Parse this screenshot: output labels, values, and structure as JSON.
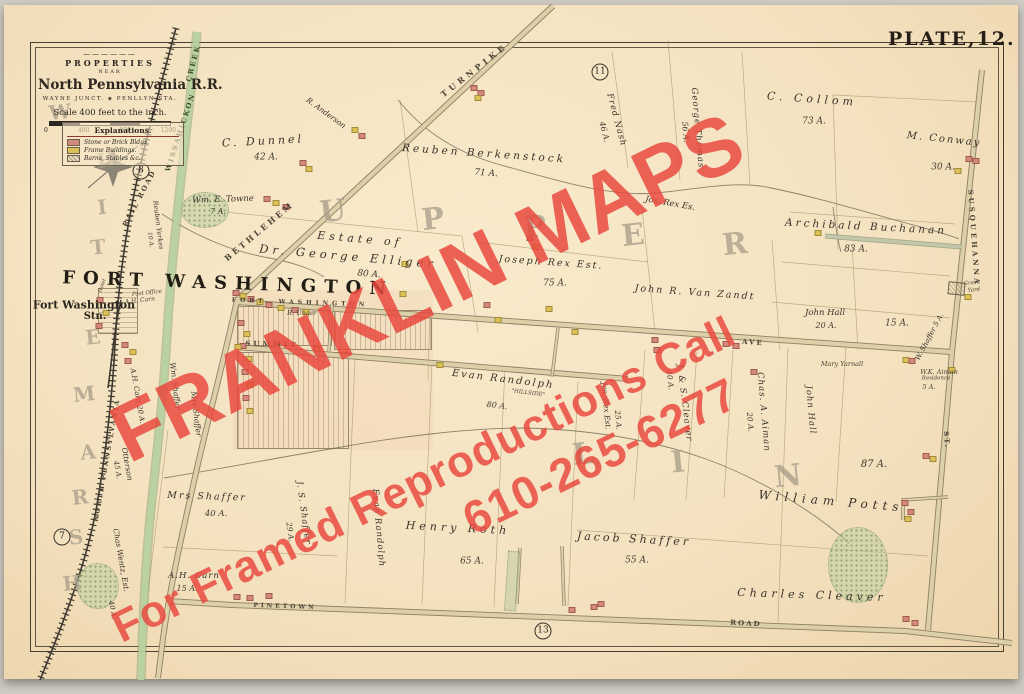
{
  "plate_label": "PLATE,12.",
  "title_block": {
    "ornament": "——————",
    "properties": "PROPERTIES",
    "near": "NEAR",
    "railroad": "North Pennsylvania R.R.",
    "stations": "WAYNE JUNCT. ◈ PENLLYN STA.",
    "scale_caption": "Scale 400 feet to the inch.",
    "scale_ticks": [
      "0",
      "400",
      "800",
      "1200"
    ]
  },
  "legend": {
    "title": "Explanations.",
    "items": [
      {
        "label": "Stone or Brick Bldgs.",
        "swatch": "stone",
        "color": "#d4897e"
      },
      {
        "label": "Frame Buildings.",
        "swatch": "frame",
        "color": "#dcc156"
      },
      {
        "label": "Barns, Stables &c.",
        "swatch": "barn",
        "color": "#e8dcbe"
      }
    ]
  },
  "watermark": {
    "line1": "FRANKLIN MAPS",
    "line2": "For Framed Reproductions Call",
    "line3": "610-265-6277",
    "color": "#e9483e"
  },
  "map_labels": [
    {
      "t": "TURNPIKE",
      "x": 474,
      "y": 70,
      "rot": -38,
      "fs": 8,
      "ls": 4,
      "cls": "road"
    },
    {
      "t": "BETHLEHEM",
      "x": 259,
      "y": 231,
      "rot": -40,
      "fs": 8,
      "ls": 3,
      "cls": "road"
    },
    {
      "t": "FORT  WASHINGTON",
      "x": 300,
      "y": 303,
      "rot": 2,
      "fs": 6,
      "ls": 4,
      "cls": "road"
    },
    {
      "t": "AVE",
      "x": 753,
      "y": 342,
      "rot": 4,
      "fs": 7,
      "ls": 2,
      "cls": "road"
    },
    {
      "t": "SUMMIT",
      "x": 272,
      "y": 344,
      "rot": 2,
      "fs": 7,
      "ls": 3,
      "cls": "road"
    },
    {
      "t": "PINETOWN",
      "x": 285,
      "y": 607,
      "rot": 2,
      "fs": 6,
      "ls": 3,
      "cls": "road"
    },
    {
      "t": "ROAD",
      "x": 746,
      "y": 623,
      "rot": 3,
      "fs": 7,
      "ls": 2,
      "cls": "road"
    },
    {
      "t": "SUSQUEHANNA",
      "x": 974,
      "y": 238,
      "rot": 86,
      "fs": 7,
      "ls": 3,
      "cls": "road"
    },
    {
      "t": "ST.",
      "x": 947,
      "y": 440,
      "rot": 86,
      "fs": 7,
      "ls": 2,
      "cls": "road"
    },
    {
      "t": "NORTH PENNSYLVANIA",
      "x": 107,
      "y": 460,
      "rot": -80,
      "fs": 6.5,
      "ls": 2,
      "cls": "road"
    },
    {
      "t": "RAIL ROAD",
      "x": 139,
      "y": 198,
      "rot": -62,
      "fs": 7,
      "ls": 2,
      "cls": "road"
    },
    {
      "t": "WISSAHICKON",
      "x": 180,
      "y": 132,
      "rot": -72,
      "fs": 7,
      "ls": 2,
      "cls": "creek"
    },
    {
      "t": "CREEK",
      "x": 193,
      "y": 63,
      "rot": -75,
      "fs": 7,
      "ls": 2,
      "cls": "creek"
    },
    {
      "t": "FORT WASHINGTON",
      "x": 228,
      "y": 284,
      "rot": 2,
      "fs": 18,
      "ls": 8,
      "cls": "village"
    },
    {
      "t": "Fort Washington",
      "x": 84,
      "y": 305,
      "fs": 11,
      "cls": "station"
    },
    {
      "t": "Stn.",
      "x": 95,
      "y": 317,
      "fs": 10,
      "cls": "station"
    },
    {
      "t": "Post Office",
      "x": 147,
      "y": 294,
      "rot": -6,
      "fs": 5.5,
      "cls": "tiny"
    },
    {
      "t": "A.H. Carn",
      "x": 140,
      "y": 301,
      "rot": -6,
      "fs": 6,
      "cls": "tiny"
    },
    {
      "t": "Hotel",
      "x": 103,
      "y": 286,
      "rot": -70,
      "fs": 5,
      "cls": "tiny"
    },
    {
      "t": "R. Unger",
      "x": 302,
      "y": 313,
      "fs": 6.5,
      "cls": "tiny"
    },
    {
      "t": "Mary Yarnall",
      "x": 842,
      "y": 364,
      "fs": 6.5,
      "cls": "tiny"
    },
    {
      "t": "W.K. Aiman",
      "x": 939,
      "y": 372,
      "fs": 6.5,
      "cls": "tiny"
    },
    {
      "t": "Residence",
      "x": 936,
      "y": 379,
      "fs": 5.5,
      "cls": "tiny"
    },
    {
      "t": "5 A.",
      "x": 929,
      "y": 387,
      "fs": 6.5,
      "cls": "tiny"
    },
    {
      "t": "Grave",
      "x": 972,
      "y": 284,
      "rot": -6,
      "fs": 5.5,
      "cls": "tiny"
    },
    {
      "t": "Yard",
      "x": 974,
      "y": 291,
      "rot": -6,
      "fs": 5.5,
      "cls": "tiny"
    },
    {
      "t": "C. Dunnel",
      "x": 263,
      "y": 141,
      "rot": -3,
      "fs": 11,
      "ls": 3,
      "cls": "prop"
    },
    {
      "t": "42 A.",
      "x": 266,
      "y": 158,
      "fs": 9,
      "cls": "acre"
    },
    {
      "t": "R. Anderson",
      "x": 326,
      "y": 113,
      "rot": 36,
      "fs": 7.5,
      "cls": "prop"
    },
    {
      "t": "Reuben Berkenstock",
      "x": 484,
      "y": 154,
      "rot": 4,
      "fs": 10.5,
      "ls": 3,
      "cls": "prop"
    },
    {
      "t": "71 A.",
      "x": 486,
      "y": 174,
      "rot": 4,
      "fs": 9,
      "cls": "acre"
    },
    {
      "t": "Fred Nash",
      "x": 616,
      "y": 120,
      "rot": 75,
      "fs": 8.5,
      "ls": 1,
      "cls": "prop"
    },
    {
      "t": "46 A.",
      "x": 604,
      "y": 132,
      "rot": 75,
      "fs": 8,
      "cls": "acre"
    },
    {
      "t": "George Thomas",
      "x": 697,
      "y": 128,
      "rot": 85,
      "fs": 8.5,
      "ls": 1,
      "cls": "prop"
    },
    {
      "t": "56 A.",
      "x": 685,
      "y": 132,
      "rot": 85,
      "fs": 8,
      "cls": "acre"
    },
    {
      "t": "C. Collom",
      "x": 812,
      "y": 99,
      "rot": 4,
      "fs": 11,
      "ls": 4,
      "cls": "prop"
    },
    {
      "t": "73 A.",
      "x": 814,
      "y": 122,
      "fs": 9,
      "cls": "acre"
    },
    {
      "t": "M. Conway",
      "x": 944,
      "y": 140,
      "rot": 6,
      "fs": 10,
      "ls": 2,
      "cls": "prop"
    },
    {
      "t": "30 A.",
      "x": 943,
      "y": 168,
      "fs": 9,
      "cls": "acre"
    },
    {
      "t": "Jos. Rex Es.",
      "x": 670,
      "y": 204,
      "rot": 10,
      "fs": 8.5,
      "cls": "prop"
    },
    {
      "t": "Archibald Buchanan",
      "x": 866,
      "y": 227,
      "rot": 3,
      "fs": 10.5,
      "ls": 3,
      "cls": "prop"
    },
    {
      "t": "83 A.",
      "x": 856,
      "y": 250,
      "fs": 9,
      "cls": "acre"
    },
    {
      "t": "Wm. E. Towne",
      "x": 223,
      "y": 200,
      "rot": -2,
      "fs": 8.5,
      "cls": "prop"
    },
    {
      "t": "7 A.",
      "x": 218,
      "y": 212,
      "fs": 8,
      "cls": "acre"
    },
    {
      "t": "Reuben Yerkes",
      "x": 158,
      "y": 225,
      "rot": 83,
      "fs": 6.5,
      "cls": "prop"
    },
    {
      "t": "10 A.",
      "x": 150,
      "y": 240,
      "rot": 83,
      "fs": 6,
      "cls": "acre"
    },
    {
      "t": "Estate of",
      "x": 360,
      "y": 239,
      "rot": 5,
      "fs": 11,
      "ls": 4,
      "cls": "prop"
    },
    {
      "t": "Dr. George Elliger",
      "x": 348,
      "y": 257,
      "rot": 5,
      "fs": 11.5,
      "ls": 4,
      "cls": "prop"
    },
    {
      "t": "80 A.",
      "x": 369,
      "y": 275,
      "rot": 5,
      "fs": 9,
      "cls": "acre"
    },
    {
      "t": "Joseph Rex Est.",
      "x": 551,
      "y": 263,
      "rot": 4,
      "fs": 9.5,
      "ls": 2,
      "cls": "prop"
    },
    {
      "t": "75 A.",
      "x": 555,
      "y": 284,
      "fs": 9,
      "cls": "acre"
    },
    {
      "t": "John R. Van Zandt",
      "x": 695,
      "y": 293,
      "rot": 4,
      "fs": 9.5,
      "ls": 2,
      "cls": "prop"
    },
    {
      "t": "John Hall",
      "x": 825,
      "y": 313,
      "fs": 8.5,
      "cls": "prop"
    },
    {
      "t": "20 A.",
      "x": 826,
      "y": 326,
      "fs": 8,
      "cls": "acre"
    },
    {
      "t": "15 A.",
      "x": 897,
      "y": 324,
      "fs": 9,
      "cls": "acre"
    },
    {
      "t": "W. Shaffer 5 A.",
      "x": 930,
      "y": 337,
      "rot": -62,
      "fs": 7,
      "cls": "prop"
    },
    {
      "t": "Evan Randolph",
      "x": 503,
      "y": 380,
      "rot": 7,
      "fs": 10,
      "ls": 2,
      "cls": "prop"
    },
    {
      "t": "\"HILLSIDE\"",
      "x": 528,
      "y": 394,
      "rot": 7,
      "fs": 5.5,
      "cls": "tiny"
    },
    {
      "t": "80 A.",
      "x": 497,
      "y": 406,
      "rot": 7,
      "fs": 8,
      "cls": "acre"
    },
    {
      "t": "J. & S. Cleaver",
      "x": 684,
      "y": 403,
      "rot": 83,
      "fs": 8.5,
      "ls": 1,
      "cls": "prop"
    },
    {
      "t": "40 A.",
      "x": 670,
      "y": 380,
      "rot": 83,
      "fs": 7.5,
      "cls": "acre"
    },
    {
      "t": "Jos. Rex Est.",
      "x": 606,
      "y": 406,
      "rot": 85,
      "fs": 7.5,
      "cls": "prop"
    },
    {
      "t": "25 A.",
      "x": 618,
      "y": 420,
      "rot": 85,
      "fs": 7.5,
      "cls": "acre"
    },
    {
      "t": "Chas. A. Aiman",
      "x": 763,
      "y": 412,
      "rot": 85,
      "fs": 8.5,
      "ls": 1,
      "cls": "prop"
    },
    {
      "t": "20 A.",
      "x": 750,
      "y": 422,
      "rot": 85,
      "fs": 7.5,
      "cls": "acre"
    },
    {
      "t": "John Hall",
      "x": 810,
      "y": 410,
      "rot": 85,
      "fs": 8.5,
      "ls": 1,
      "cls": "prop"
    },
    {
      "t": "87 A.",
      "x": 874,
      "y": 465,
      "fs": 10,
      "cls": "acre"
    },
    {
      "t": "William Potts",
      "x": 831,
      "y": 501,
      "rot": 5,
      "fs": 12,
      "ls": 5,
      "cls": "prop"
    },
    {
      "t": "Charles Cleaver",
      "x": 812,
      "y": 595,
      "rot": 2,
      "fs": 11,
      "ls": 4,
      "cls": "prop"
    },
    {
      "t": "Jacob Shaffer",
      "x": 634,
      "y": 539,
      "rot": 3,
      "fs": 11,
      "ls": 3,
      "cls": "prop"
    },
    {
      "t": "55 A.",
      "x": 637,
      "y": 561,
      "fs": 9,
      "cls": "acre"
    },
    {
      "t": "Henry Roth",
      "x": 458,
      "y": 528,
      "rot": 3,
      "fs": 11,
      "ls": 4,
      "cls": "prop"
    },
    {
      "t": "65 A.",
      "x": 472,
      "y": 562,
      "fs": 9,
      "cls": "acre"
    },
    {
      "t": "Evan Randolph",
      "x": 378,
      "y": 528,
      "rot": 85,
      "fs": 8.5,
      "ls": 1,
      "cls": "prop"
    },
    {
      "t": "J. S. Shaffer",
      "x": 303,
      "y": 513,
      "rot": 82,
      "fs": 8.5,
      "ls": 1,
      "cls": "prop"
    },
    {
      "t": "29 A.",
      "x": 290,
      "y": 532,
      "rot": 82,
      "fs": 7.5,
      "cls": "acre"
    },
    {
      "t": "Mrs Shaffer",
      "x": 207,
      "y": 497,
      "rot": 2,
      "fs": 9.5,
      "ls": 2,
      "cls": "prop"
    },
    {
      "t": "40 A.",
      "x": 216,
      "y": 514,
      "fs": 8.5,
      "cls": "acre"
    },
    {
      "t": "A.H. Carn",
      "x": 194,
      "y": 576,
      "fs": 8.5,
      "ls": 1,
      "cls": "prop"
    },
    {
      "t": "15 A.",
      "x": 187,
      "y": 589,
      "fs": 8,
      "cls": "acre"
    },
    {
      "t": "Otterson",
      "x": 127,
      "y": 464,
      "rot": 80,
      "fs": 7.5,
      "cls": "prop"
    },
    {
      "t": "45 A.",
      "x": 117,
      "y": 470,
      "rot": 80,
      "fs": 7,
      "cls": "acre"
    },
    {
      "t": "Chas Wentz, Est.",
      "x": 121,
      "y": 560,
      "rot": 80,
      "fs": 7.5,
      "cls": "prop"
    },
    {
      "t": "40 A.",
      "x": 112,
      "y": 610,
      "rot": 80,
      "fs": 7,
      "cls": "acre"
    },
    {
      "t": "A.H. Carn 20 A.",
      "x": 137,
      "y": 396,
      "rot": 80,
      "fs": 7,
      "cls": "prop"
    },
    {
      "t": "Wm. Shaffer",
      "x": 175,
      "y": 386,
      "rot": 83,
      "fs": 7.5,
      "cls": "prop"
    },
    {
      "t": "Mrs Shaffer",
      "x": 196,
      "y": 414,
      "rot": 83,
      "fs": 7.5,
      "cls": "prop"
    }
  ],
  "big_letters": [
    {
      "t": "U",
      "x": 333,
      "y": 212,
      "fs": 30
    },
    {
      "t": "P",
      "x": 433,
      "y": 220,
      "fs": 30
    },
    {
      "t": "P",
      "x": 535,
      "y": 228,
      "fs": 30
    },
    {
      "t": "E",
      "x": 633,
      "y": 236,
      "fs": 30
    },
    {
      "t": "R",
      "x": 735,
      "y": 245,
      "fs": 30
    },
    {
      "t": "L",
      "x": 583,
      "y": 455,
      "fs": 30
    },
    {
      "t": "I",
      "x": 678,
      "y": 463,
      "fs": 30
    },
    {
      "t": "N",
      "x": 788,
      "y": 477,
      "fs": 30
    },
    {
      "t": "W",
      "x": 60,
      "y": 112,
      "fs": 20
    },
    {
      "t": "H",
      "x": 106,
      "y": 160,
      "fs": 20
    },
    {
      "t": "I",
      "x": 102,
      "y": 207,
      "fs": 20
    },
    {
      "t": "T",
      "x": 98,
      "y": 247,
      "fs": 20
    },
    {
      "t": "E",
      "x": 93,
      "y": 337,
      "fs": 20
    },
    {
      "t": "M",
      "x": 84,
      "y": 394,
      "fs": 20
    },
    {
      "t": "A",
      "x": 88,
      "y": 452,
      "fs": 20
    },
    {
      "t": "R",
      "x": 80,
      "y": 497,
      "fs": 20
    },
    {
      "t": "S",
      "x": 76,
      "y": 537,
      "fs": 20
    },
    {
      "t": "H",
      "x": 72,
      "y": 583,
      "fs": 20
    }
  ],
  "circled_numbers": [
    {
      "n": "8",
      "x": 141,
      "y": 171
    },
    {
      "n": "11",
      "x": 600,
      "y": 72
    },
    {
      "n": "7",
      "x": 62,
      "y": 537
    },
    {
      "n": "13",
      "x": 543,
      "y": 631
    }
  ],
  "buildings": [
    {
      "x": 474,
      "y": 88,
      "t": "s"
    },
    {
      "x": 481,
      "y": 93,
      "t": "s"
    },
    {
      "x": 478,
      "y": 98,
      "t": "f"
    },
    {
      "x": 355,
      "y": 130,
      "t": "f"
    },
    {
      "x": 362,
      "y": 136,
      "t": "s"
    },
    {
      "x": 303,
      "y": 163,
      "t": "s"
    },
    {
      "x": 309,
      "y": 169,
      "t": "f"
    },
    {
      "x": 267,
      "y": 199,
      "t": "s"
    },
    {
      "x": 276,
      "y": 203,
      "t": "f"
    },
    {
      "x": 286,
      "y": 207,
      "t": "s"
    },
    {
      "x": 405,
      "y": 264,
      "t": "f"
    },
    {
      "x": 403,
      "y": 294,
      "t": "f"
    },
    {
      "x": 530,
      "y": 238,
      "t": "s"
    },
    {
      "x": 536,
      "y": 247,
      "t": "f"
    },
    {
      "x": 487,
      "y": 305,
      "t": "s"
    },
    {
      "x": 498,
      "y": 320,
      "t": "f"
    },
    {
      "x": 549,
      "y": 309,
      "t": "f"
    },
    {
      "x": 236,
      "y": 293,
      "t": "s"
    },
    {
      "x": 243,
      "y": 296,
      "t": "f"
    },
    {
      "x": 251,
      "y": 299,
      "t": "s"
    },
    {
      "x": 260,
      "y": 302,
      "t": "f"
    },
    {
      "x": 269,
      "y": 305,
      "t": "s"
    },
    {
      "x": 281,
      "y": 308,
      "t": "f"
    },
    {
      "x": 295,
      "y": 310,
      "t": "s"
    },
    {
      "x": 306,
      "y": 312,
      "t": "f"
    },
    {
      "x": 241,
      "y": 323,
      "t": "s"
    },
    {
      "x": 247,
      "y": 334,
      "t": "f"
    },
    {
      "x": 243,
      "y": 346,
      "t": "s"
    },
    {
      "x": 249,
      "y": 359,
      "t": "f"
    },
    {
      "x": 245,
      "y": 372,
      "t": "s"
    },
    {
      "x": 250,
      "y": 385,
      "t": "f"
    },
    {
      "x": 246,
      "y": 398,
      "t": "s"
    },
    {
      "x": 250,
      "y": 411,
      "t": "f"
    },
    {
      "x": 100,
      "y": 300,
      "t": "s"
    },
    {
      "x": 106,
      "y": 313,
      "t": "f"
    },
    {
      "x": 99,
      "y": 326,
      "t": "s"
    },
    {
      "x": 125,
      "y": 345,
      "t": "s"
    },
    {
      "x": 133,
      "y": 352,
      "t": "f"
    },
    {
      "x": 128,
      "y": 361,
      "t": "s"
    },
    {
      "x": 238,
      "y": 347,
      "t": "f"
    },
    {
      "x": 317,
      "y": 349,
      "t": "f"
    },
    {
      "x": 440,
      "y": 365,
      "t": "f"
    },
    {
      "x": 655,
      "y": 340,
      "t": "s"
    },
    {
      "x": 657,
      "y": 350,
      "t": "s"
    },
    {
      "x": 726,
      "y": 344,
      "t": "s"
    },
    {
      "x": 736,
      "y": 346,
      "t": "s"
    },
    {
      "x": 575,
      "y": 332,
      "t": "f"
    },
    {
      "x": 754,
      "y": 372,
      "t": "s"
    },
    {
      "x": 969,
      "y": 159,
      "t": "s"
    },
    {
      "x": 976,
      "y": 161,
      "t": "s"
    },
    {
      "x": 958,
      "y": 171,
      "t": "f"
    },
    {
      "x": 818,
      "y": 233,
      "t": "f"
    },
    {
      "x": 906,
      "y": 360,
      "t": "f"
    },
    {
      "x": 912,
      "y": 361,
      "t": "s"
    },
    {
      "x": 968,
      "y": 297,
      "t": "f"
    },
    {
      "x": 952,
      "y": 370,
      "t": "f"
    },
    {
      "x": 905,
      "y": 503,
      "t": "s"
    },
    {
      "x": 911,
      "y": 512,
      "t": "s"
    },
    {
      "x": 908,
      "y": 519,
      "t": "f"
    },
    {
      "x": 926,
      "y": 456,
      "t": "s"
    },
    {
      "x": 933,
      "y": 459,
      "t": "f"
    },
    {
      "x": 906,
      "y": 619,
      "t": "s"
    },
    {
      "x": 915,
      "y": 623,
      "t": "s"
    },
    {
      "x": 572,
      "y": 610,
      "t": "s"
    },
    {
      "x": 594,
      "y": 607,
      "t": "s"
    },
    {
      "x": 601,
      "y": 604,
      "t": "s"
    },
    {
      "x": 237,
      "y": 597,
      "t": "s"
    },
    {
      "x": 250,
      "y": 598,
      "t": "s"
    },
    {
      "x": 269,
      "y": 596,
      "t": "s"
    }
  ],
  "trees": [
    {
      "x": 205,
      "y": 210,
      "w": 46,
      "h": 34
    },
    {
      "x": 858,
      "y": 565,
      "w": 58,
      "h": 74
    },
    {
      "x": 98,
      "y": 586,
      "w": 40,
      "h": 44
    }
  ]
}
